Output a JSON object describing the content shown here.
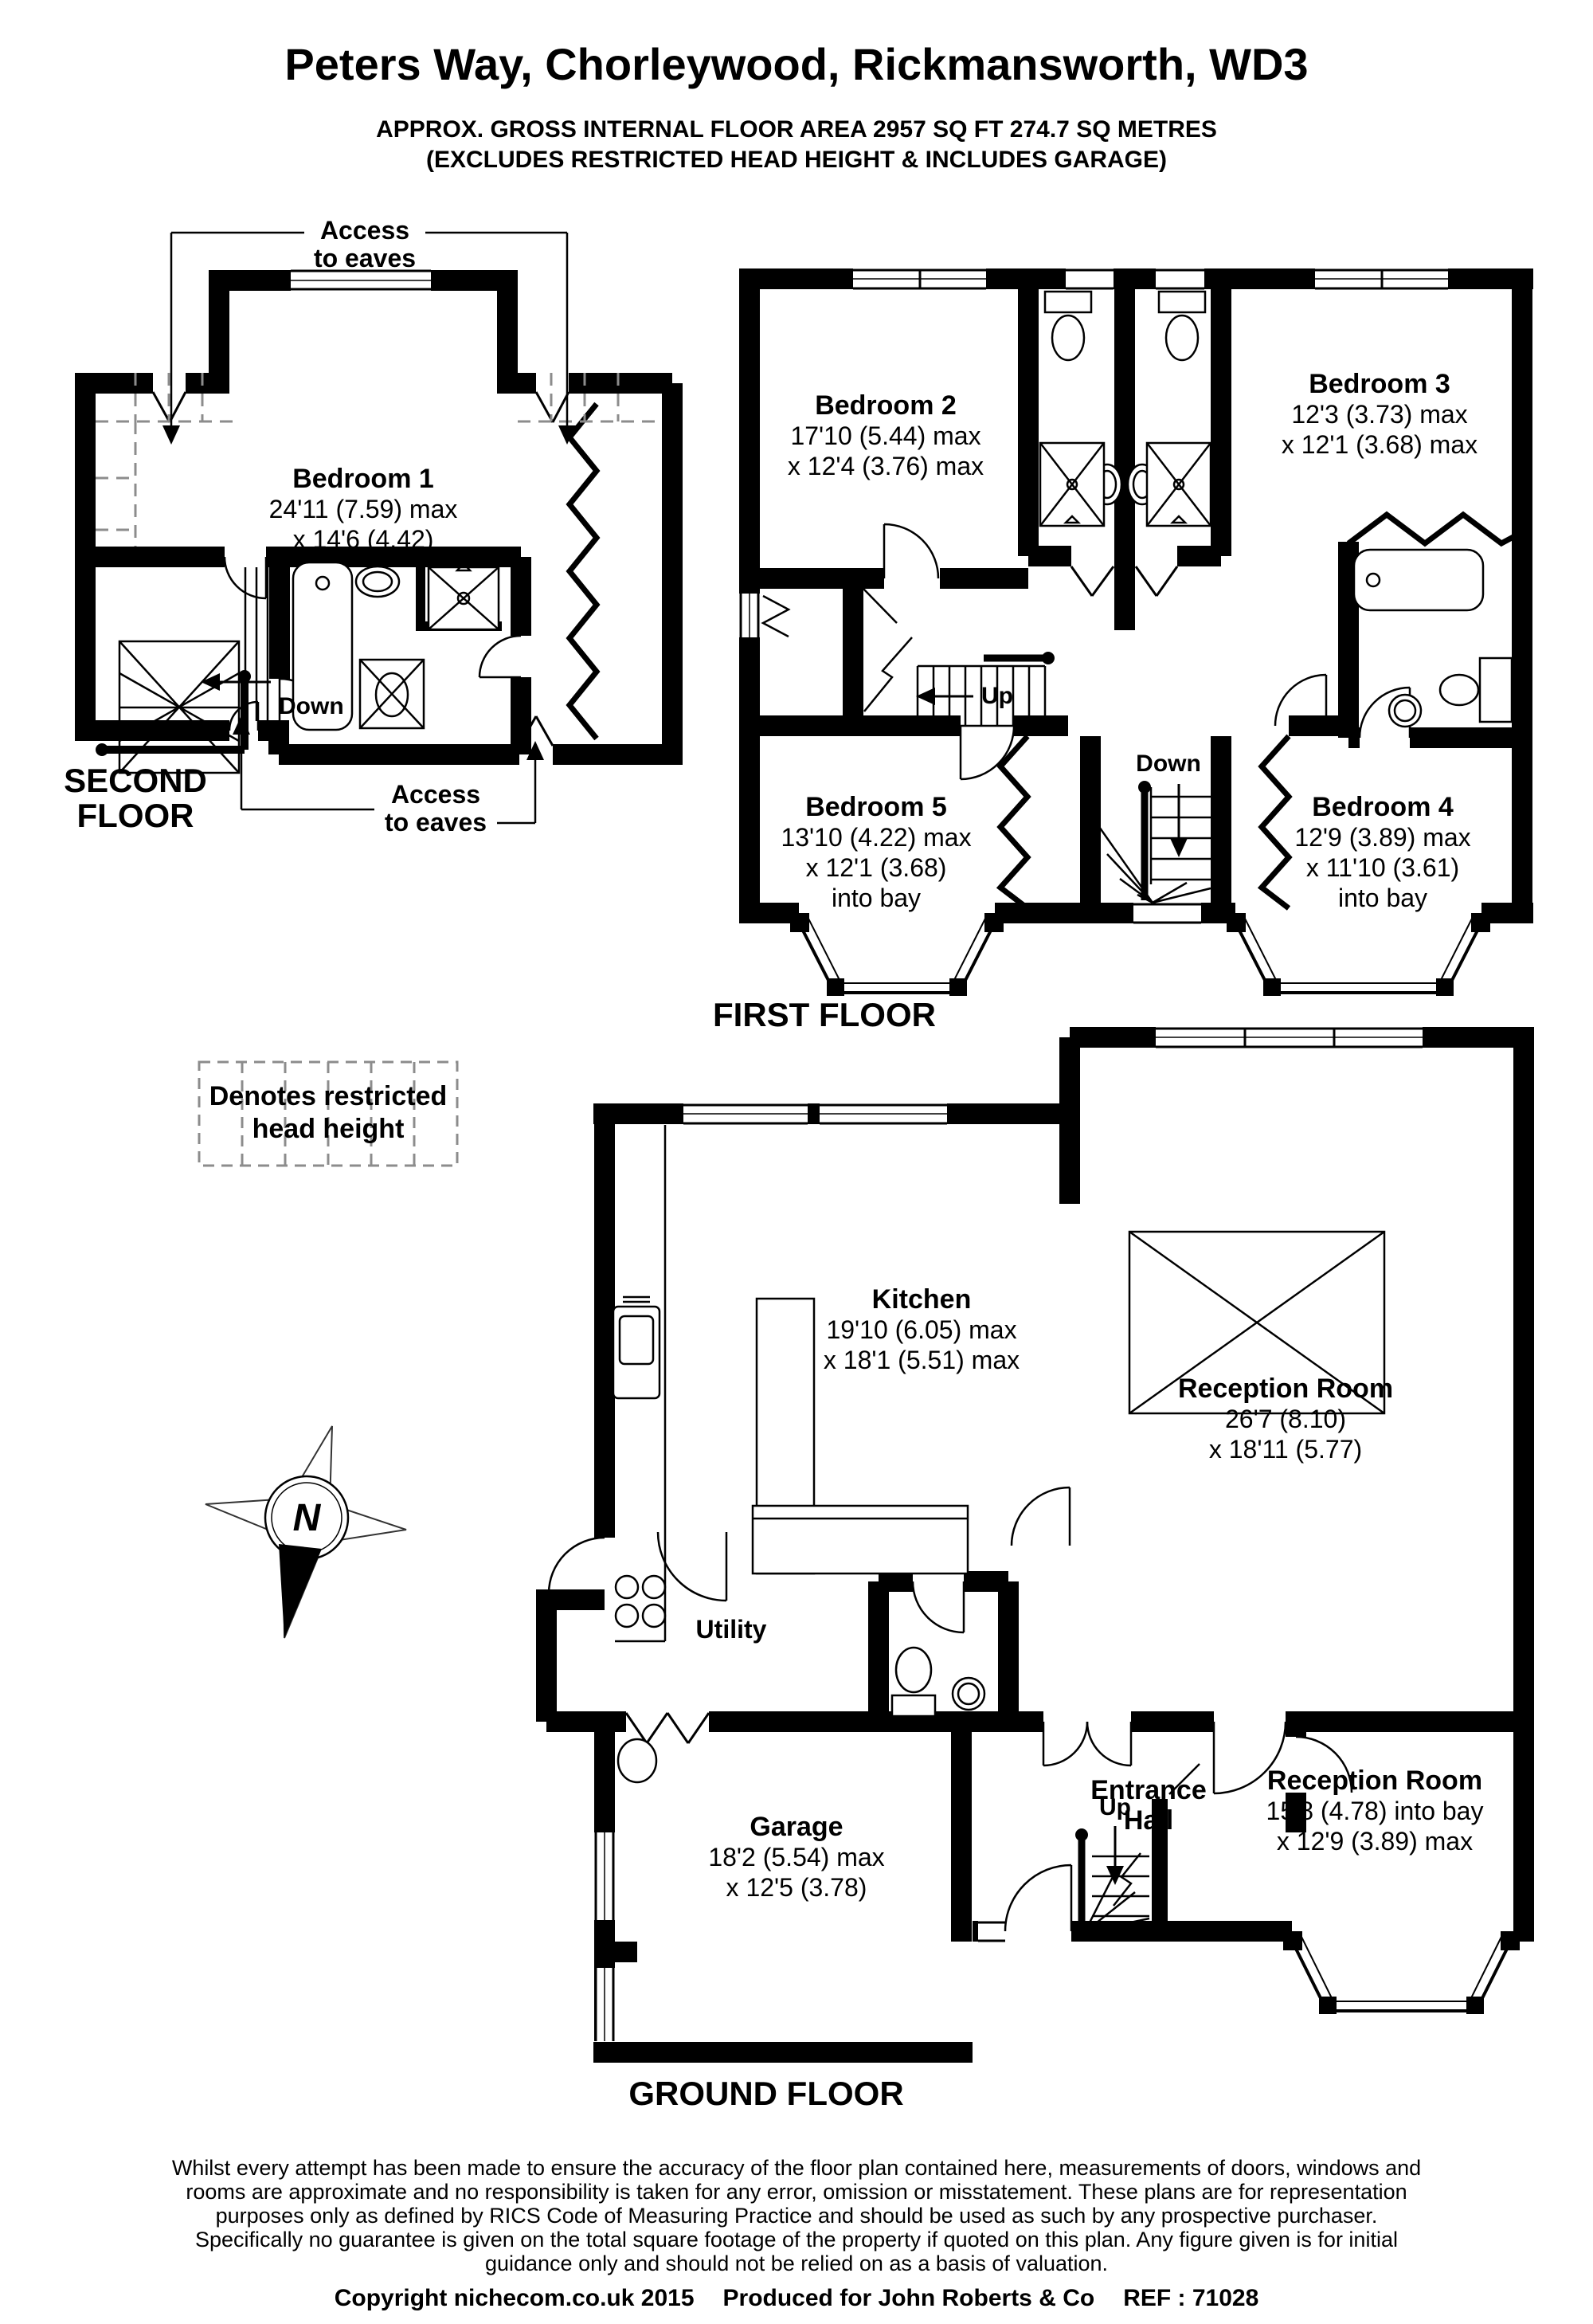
{
  "header": {
    "title": "Peters Way, Chorleywood, Rickmansworth, WD3",
    "area_line1": "APPROX. GROSS INTERNAL FLOOR AREA 2957 SQ FT 274.7 SQ METRES",
    "area_line2": "(EXCLUDES RESTRICTED HEAD HEIGHT & INCLUDES GARAGE)"
  },
  "second_floor": {
    "floor_label_lines": [
      "SECOND",
      "FLOOR"
    ],
    "access_to_eaves_top": [
      "Access",
      "to eaves"
    ],
    "access_to_eaves_bottom": [
      "Access",
      "to eaves"
    ],
    "down_label": "Down",
    "bedroom1": {
      "name": "Bedroom 1",
      "dims": [
        "24'11 (7.59) max",
        "x 14'6 (4.42)"
      ]
    }
  },
  "first_floor": {
    "floor_label": "FIRST FLOOR",
    "up_label": "Up",
    "down_label": "Down",
    "bedroom2": {
      "name": "Bedroom 2",
      "dims": [
        "17'10 (5.44) max",
        "x 12'4 (3.76) max"
      ]
    },
    "bedroom3": {
      "name": "Bedroom 3",
      "dims": [
        "12'3 (3.73) max",
        "x 12'1 (3.68) max"
      ]
    },
    "bedroom5": {
      "name": "Bedroom 5",
      "dims": [
        "13'10 (4.22) max",
        "x 12'1 (3.68)",
        "into bay"
      ]
    },
    "bedroom4": {
      "name": "Bedroom 4",
      "dims": [
        "12'9 (3.89) max",
        "x 11'10 (3.61)",
        "into bay"
      ]
    }
  },
  "ground_floor": {
    "floor_label": "GROUND FLOOR",
    "up_label": "Up",
    "kitchen": {
      "name": "Kitchen",
      "dims": [
        "19'10 (6.05) max",
        "x 18'1 (5.51) max"
      ]
    },
    "reception1": {
      "name": "Reception Room",
      "dims": [
        "26'7 (8.10)",
        "x 18'11 (5.77)"
      ]
    },
    "reception2": {
      "name": "Reception Room",
      "dims": [
        "15'8 (4.78) into bay",
        "x 12'9 (3.89) max"
      ]
    },
    "garage": {
      "name": "Garage",
      "dims": [
        "18'2 (5.54) max",
        "x 12'5 (3.78)"
      ]
    },
    "utility_label": "Utility",
    "entrance_hall_lines": [
      "Entrance",
      "Hall"
    ]
  },
  "legend": {
    "restricted_lines": [
      "Denotes restricted",
      "head height"
    ],
    "north_label": "N"
  },
  "footer": {
    "disclaimer_lines": [
      "Whilst every attempt has been made to ensure the accuracy of the floor plan contained here, measurements of doors, windows and",
      "rooms are approximate and no responsibility is taken for any error, omission or misstatement. These plans are for representation",
      "purposes only as defined by RICS Code of Measuring Practice and should be used as such by any prospective purchaser.",
      "Specifically no guarantee is given on the total square footage of the property if quoted on this plan. Any figure given is for initial",
      "guidance only and should not be relied on as a basis of valuation."
    ],
    "copyright_parts": [
      "Copyright nichecom.co.uk 2015",
      "Produced for John Roberts & Co",
      "REF : 71028"
    ]
  }
}
